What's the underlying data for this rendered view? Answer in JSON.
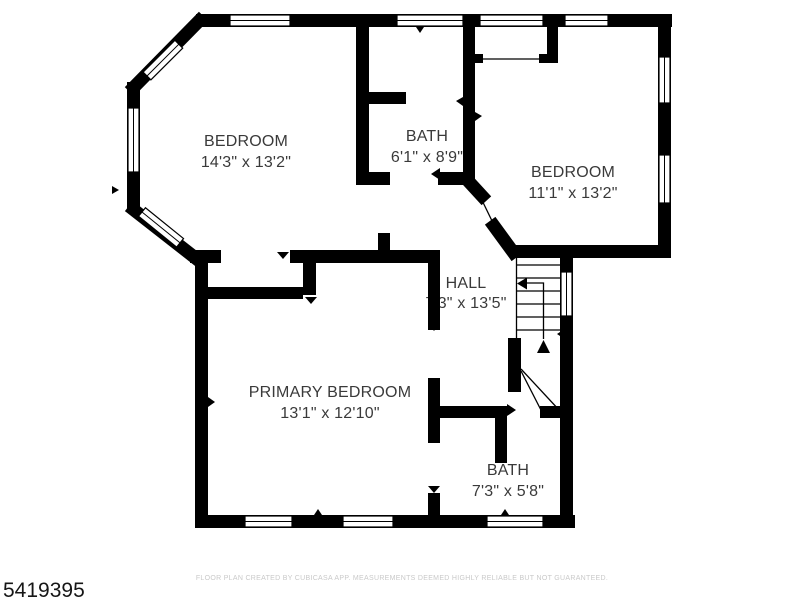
{
  "plan": {
    "id_number": "5419395",
    "footer": "FLOOR PLAN CREATED BY CUBICASA APP. MEASUREMENTS DEEMED HIGHLY RELIABLE BUT NOT GUARANTEED.",
    "wall_color": "#000000",
    "label_color": "#3a3a3a",
    "footer_color": "#c9c9c9",
    "rooms": [
      {
        "name": "BEDROOM",
        "dimensions": "14'3\" x 13'2\""
      },
      {
        "name": "BATH",
        "dimensions": "6'1\" x 8'9\""
      },
      {
        "name": "BEDROOM",
        "dimensions": "11'1\" x 13'2\""
      },
      {
        "name": "HALL",
        "dimensions": "7'3\" x 13'5\""
      },
      {
        "name": "PRIMARY BEDROOM",
        "dimensions": "13'1\" x 12'10\""
      },
      {
        "name": "BATH",
        "dimensions": "7'3\" x 5'8\""
      }
    ]
  }
}
